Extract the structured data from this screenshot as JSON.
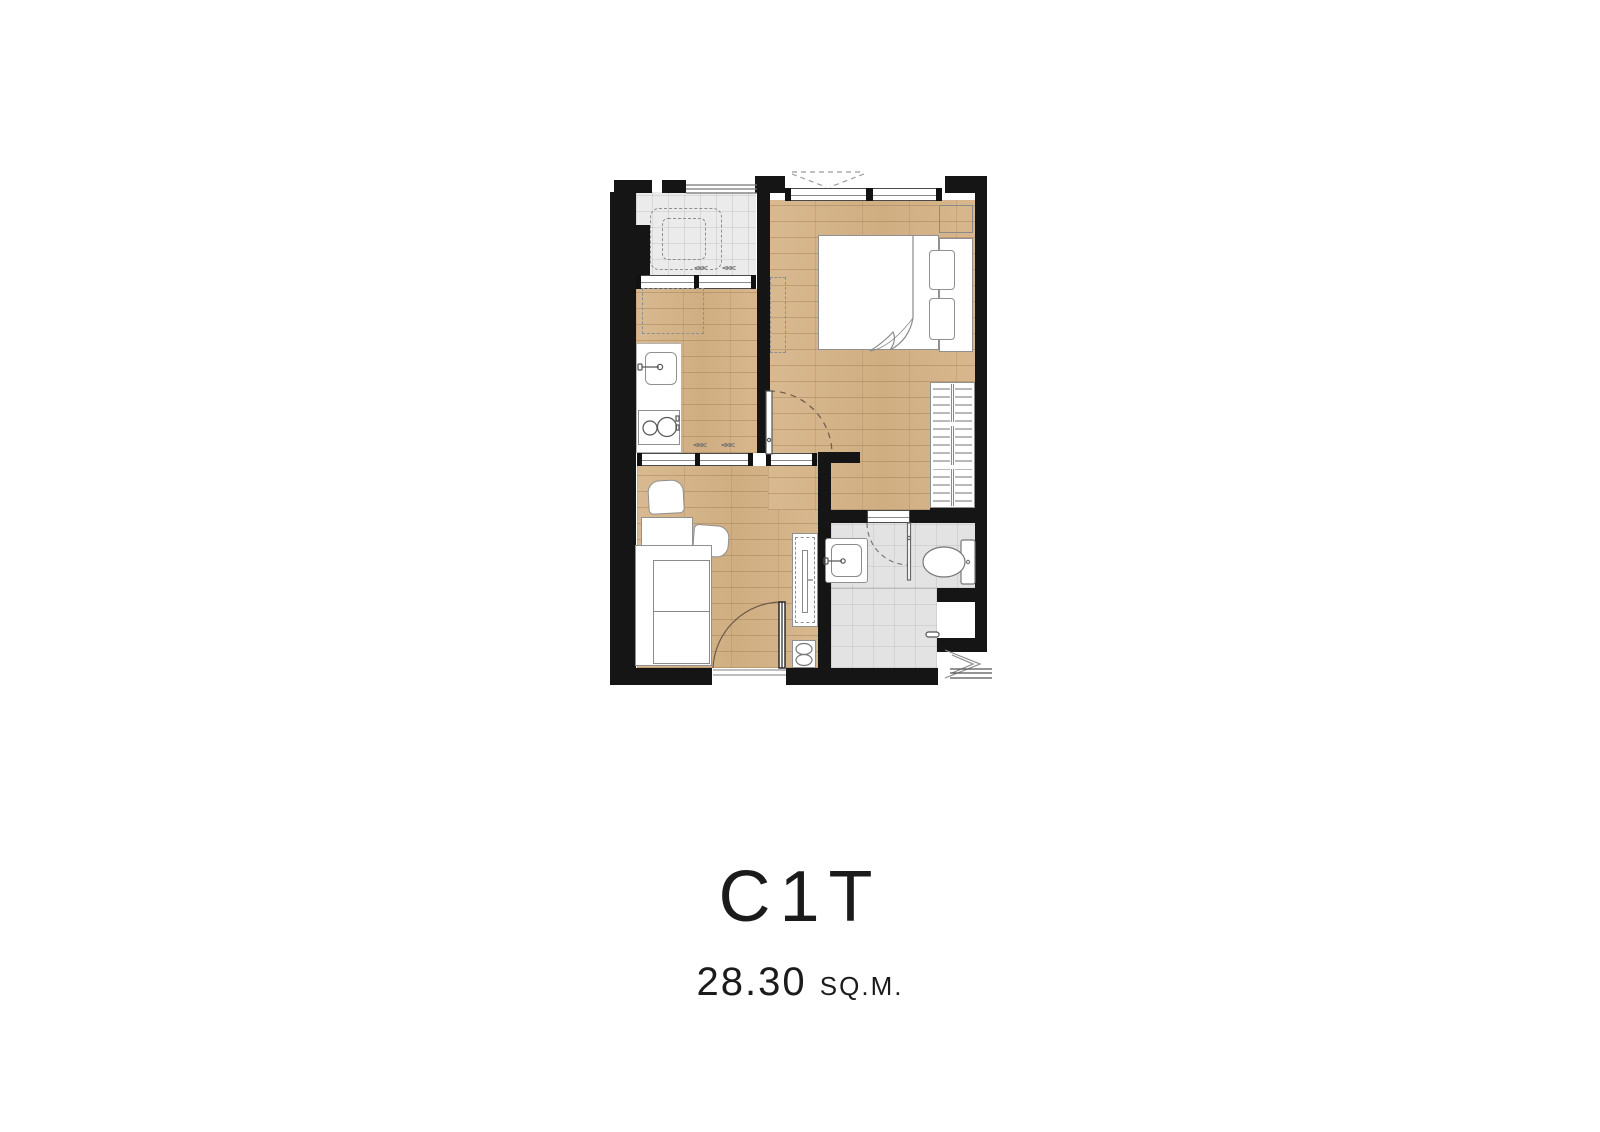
{
  "caption": {
    "unit_name": "C1T",
    "area_value": "28.30",
    "area_unit": "SQ.M."
  },
  "symbols": {
    "sliding_chevrons": "<<<"
  },
  "palette": {
    "wall": "#151515",
    "wood_floor": "#d6b58c",
    "tile_floor": "#ebebeb",
    "shower_tile": "#e3e3e3",
    "furniture_fill": "#ffffff",
    "outline": "#8f8f8f",
    "background": "#ffffff",
    "text": "#1b1b1b"
  }
}
